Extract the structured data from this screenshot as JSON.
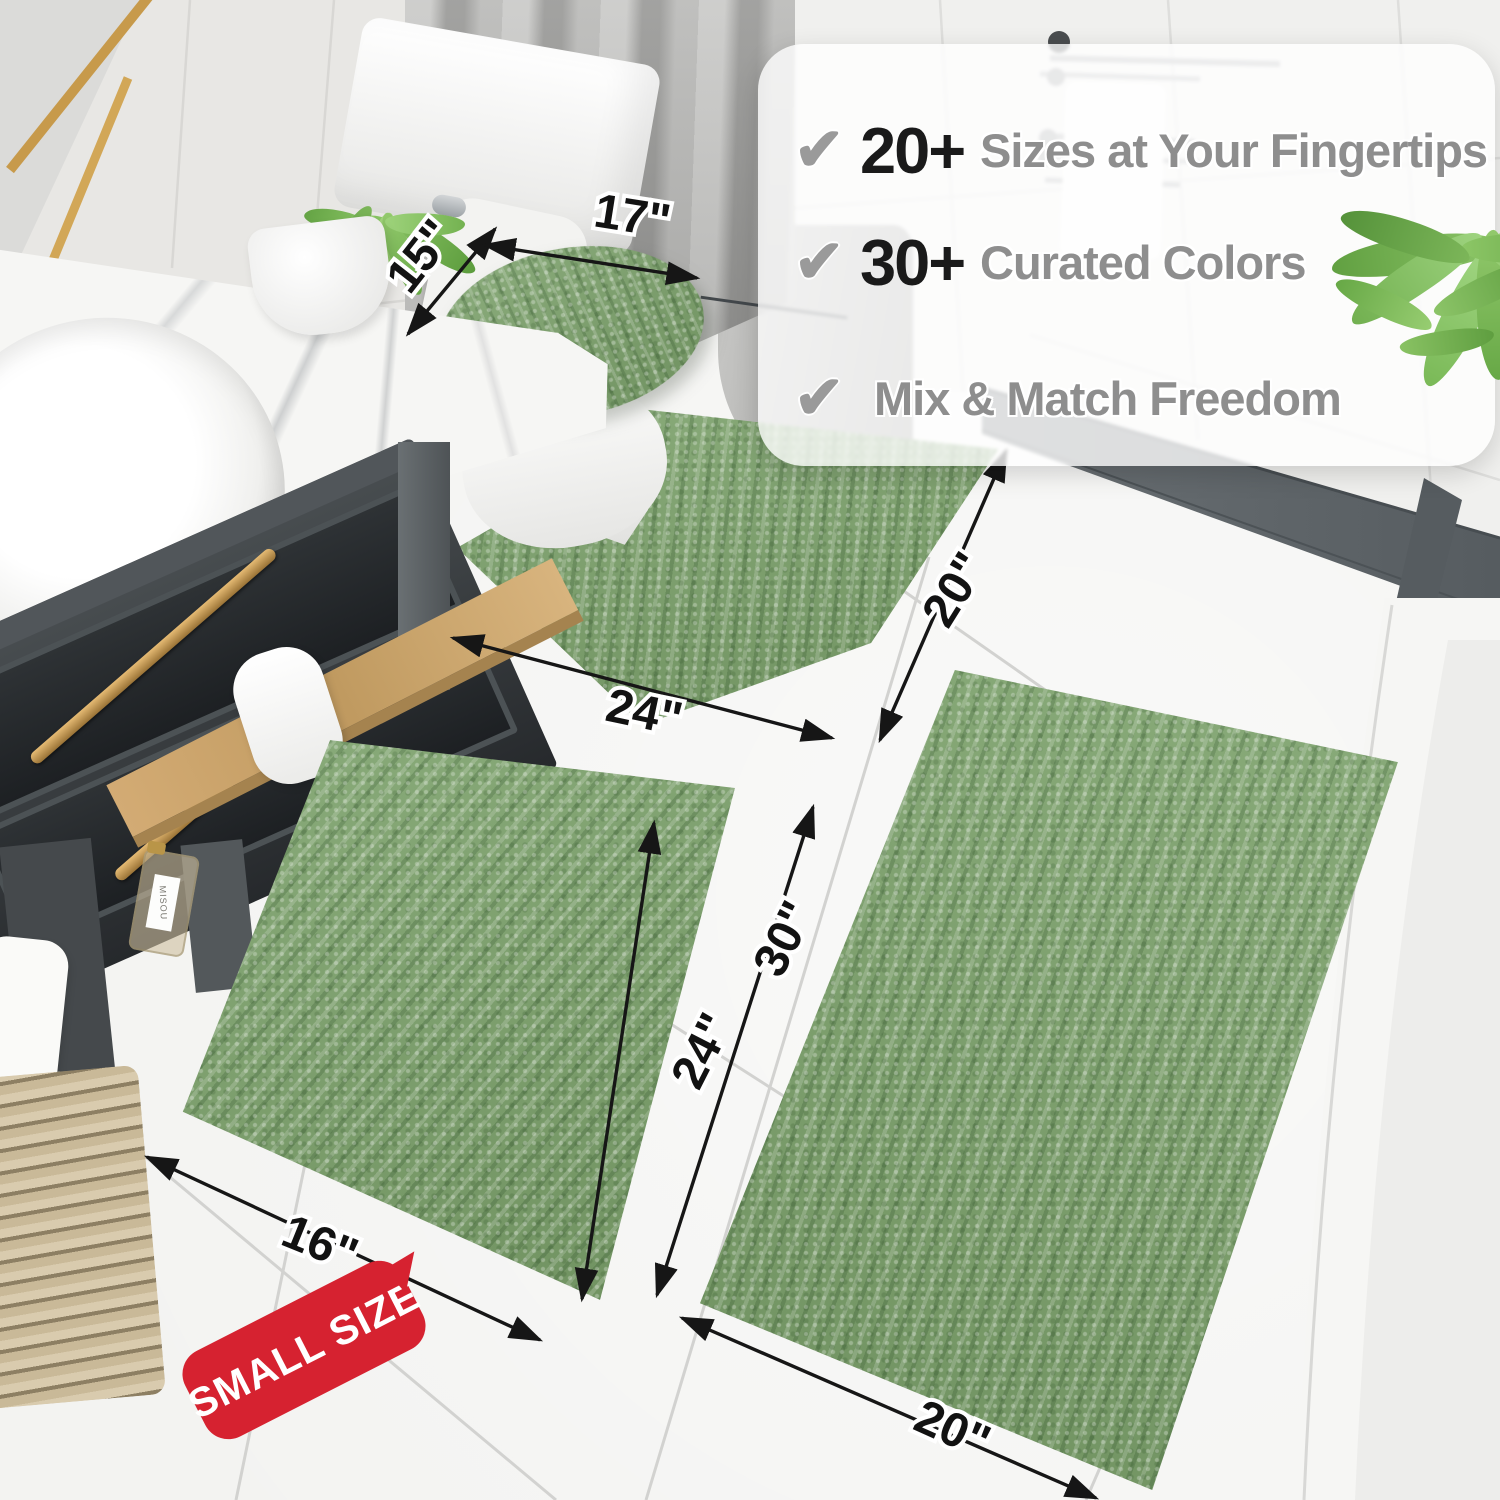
{
  "callout": {
    "check_icon": "✔",
    "rows": [
      {
        "number": "20+",
        "label": "Sizes at Your Fingertips"
      },
      {
        "number": "30+",
        "label": "Curated Colors"
      },
      {
        "number": "",
        "label": "Mix & Match Freedom"
      }
    ]
  },
  "dimensions": {
    "lid_width": "15\"",
    "lid_length": "17\"",
    "contour_length": "24\"",
    "contour_depth": "20\"",
    "small_rug_length": "24\"",
    "small_rug_width": "16\"",
    "large_rug_length": "30\"",
    "large_rug_width": "20\""
  },
  "badge": {
    "label": "SMALL SIZE"
  },
  "bottle": {
    "label": "MISOU"
  },
  "colors": {
    "rug_green": "#7ca26b",
    "rug_green_dark": "#5e7f4e",
    "badge_red": "#d62230",
    "gold_accent": "#c49a55",
    "callout_number": "#1a1a1a",
    "callout_text": "#8e8e8e",
    "check_gray": "#9a9a9a",
    "curb_gray": "#60666a",
    "wood": "#c9a469"
  }
}
